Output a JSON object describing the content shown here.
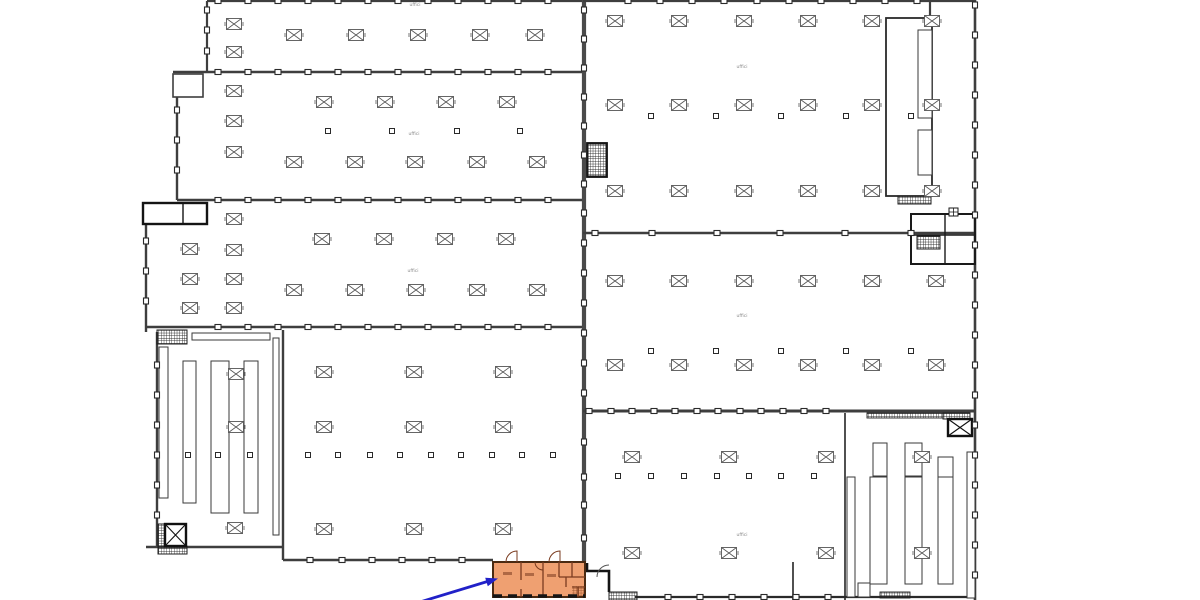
{
  "meta": {
    "description": "CAD floor plan of a large industrial building complex; column grid halls, racking areas, stair and lift cores, with a group of small rooms highlighted in orange at the bottom and a blue annotation arrow pointing to them",
    "canvas": {
      "width": 1200,
      "height": 600
    }
  },
  "colors": {
    "background": "#ffffff",
    "wall_gray": "#3e3e3e",
    "wall_black": "#141414",
    "divider_gray": "#4a4a4a",
    "column_stroke": "#555555",
    "dot_stroke": "#2a2a2a",
    "rack_stroke": "#3a3a3a",
    "hatch_stroke": "#1f1f1f",
    "highlight_fill": "#efa071",
    "highlight_wall": "#4a2a12",
    "highlight_inner": "#7a3b1f",
    "highlight_hatch": "#8a4520",
    "arrow_blue": "#2121c8",
    "label_gray": "#8a8a8a"
  },
  "labels": [
    {
      "text": "uffici",
      "x": 415,
      "y": 6
    },
    {
      "text": "uffici",
      "x": 414,
      "y": 135
    },
    {
      "text": "uffici",
      "x": 413,
      "y": 272
    },
    {
      "text": "uffici",
      "x": 742,
      "y": 68
    },
    {
      "text": "uffici",
      "x": 742,
      "y": 317
    },
    {
      "text": "uffici",
      "x": 742,
      "y": 536
    }
  ],
  "highlight": {
    "x": 493,
    "y": 562,
    "w": 92,
    "h": 35,
    "smudges": [
      [
        503,
        572,
        9,
        3
      ],
      [
        525,
        573,
        9,
        3
      ],
      [
        547,
        574,
        9,
        3
      ]
    ],
    "stair_hatch": [
      572,
      586,
      12,
      10
    ]
  },
  "arrow": {
    "x1": 420,
    "y1": 602,
    "x2": 489,
    "y2": 581,
    "tip": [
      498,
      578.5
    ],
    "head": [
      [
        498,
        578.5
      ],
      [
        487.8,
        586.3
      ],
      [
        485.2,
        577.7
      ]
    ]
  },
  "plan": {
    "xboxes": [
      [
        234,
        24
      ],
      [
        234,
        52
      ],
      [
        294,
        35
      ],
      [
        356,
        35
      ],
      [
        418,
        35
      ],
      [
        480,
        35
      ],
      [
        535,
        35
      ],
      [
        234,
        91
      ],
      [
        234,
        121
      ],
      [
        234,
        152
      ],
      [
        324,
        102
      ],
      [
        385,
        102
      ],
      [
        446,
        102
      ],
      [
        507,
        102
      ],
      [
        294,
        162
      ],
      [
        355,
        162
      ],
      [
        415,
        162
      ],
      [
        477,
        162
      ],
      [
        537,
        162
      ],
      [
        190,
        249
      ],
      [
        190,
        279
      ],
      [
        190,
        308
      ],
      [
        234,
        219
      ],
      [
        234,
        250
      ],
      [
        234,
        279
      ],
      [
        234,
        308
      ],
      [
        322,
        239
      ],
      [
        384,
        239
      ],
      [
        445,
        239
      ],
      [
        506,
        239
      ],
      [
        294,
        290
      ],
      [
        355,
        290
      ],
      [
        416,
        290
      ],
      [
        477,
        290
      ],
      [
        537,
        290
      ],
      [
        324,
        372
      ],
      [
        414,
        372
      ],
      [
        503,
        372
      ],
      [
        324,
        427
      ],
      [
        414,
        427
      ],
      [
        503,
        427
      ],
      [
        324,
        529
      ],
      [
        414,
        529
      ],
      [
        503,
        529
      ],
      [
        236,
        374
      ],
      [
        236,
        427
      ],
      [
        235,
        528
      ],
      [
        615,
        21
      ],
      [
        679,
        21
      ],
      [
        744,
        21
      ],
      [
        808,
        21
      ],
      [
        872,
        21
      ],
      [
        932,
        21
      ],
      [
        615,
        105
      ],
      [
        679,
        105
      ],
      [
        744,
        105
      ],
      [
        808,
        105
      ],
      [
        872,
        105
      ],
      [
        932,
        105
      ],
      [
        615,
        191
      ],
      [
        679,
        191
      ],
      [
        744,
        191
      ],
      [
        808,
        191
      ],
      [
        872,
        191
      ],
      [
        932,
        191
      ],
      [
        615,
        281
      ],
      [
        679,
        281
      ],
      [
        744,
        281
      ],
      [
        808,
        281
      ],
      [
        872,
        281
      ],
      [
        936,
        281
      ],
      [
        615,
        365
      ],
      [
        679,
        365
      ],
      [
        744,
        365
      ],
      [
        808,
        365
      ],
      [
        872,
        365
      ],
      [
        936,
        365
      ],
      [
        632,
        457
      ],
      [
        729,
        457
      ],
      [
        826,
        457
      ],
      [
        922,
        457
      ],
      [
        632,
        553
      ],
      [
        729,
        553
      ],
      [
        826,
        553
      ],
      [
        922,
        553
      ]
    ],
    "dots": [
      [
        328,
        131
      ],
      [
        392,
        131
      ],
      [
        457,
        131
      ],
      [
        520,
        131
      ],
      [
        308,
        455
      ],
      [
        338,
        455
      ],
      [
        370,
        455
      ],
      [
        400,
        455
      ],
      [
        431,
        455
      ],
      [
        461,
        455
      ],
      [
        492,
        455
      ],
      [
        522,
        455
      ],
      [
        553,
        455
      ],
      [
        188,
        455
      ],
      [
        218,
        455
      ],
      [
        250,
        455
      ],
      [
        651,
        116
      ],
      [
        716,
        116
      ],
      [
        781,
        116
      ],
      [
        846,
        116
      ],
      [
        911,
        116
      ],
      [
        651,
        351
      ],
      [
        716,
        351
      ],
      [
        781,
        351
      ],
      [
        846,
        351
      ],
      [
        911,
        351
      ],
      [
        618,
        476
      ],
      [
        651,
        476
      ],
      [
        684,
        476
      ],
      [
        717,
        476
      ],
      [
        749,
        476
      ],
      [
        781,
        476
      ],
      [
        814,
        476
      ]
    ],
    "wall_dots_h": [
      [
        1,
        [
          218,
          248,
          278,
          308,
          338,
          368,
          398,
          428,
          458,
          488,
          518,
          548
        ]
      ],
      [
        1,
        [
          628,
          660,
          692,
          724,
          757,
          789,
          821,
          853,
          885,
          917
        ]
      ],
      [
        72,
        [
          218,
          248,
          278,
          308,
          338,
          368,
          398,
          428,
          458,
          488,
          518,
          548
        ]
      ],
      [
        200,
        [
          218,
          248,
          278,
          308,
          338,
          368,
          398,
          428,
          458,
          488,
          518,
          548
        ]
      ],
      [
        327,
        [
          218,
          248,
          278,
          308,
          338,
          368,
          398,
          428,
          458,
          488,
          518,
          548
        ]
      ],
      [
        233,
        [
          595,
          652,
          717,
          780,
          845,
          911
        ]
      ],
      [
        411,
        [
          589,
          611,
          632,
          654,
          675,
          697,
          718,
          740,
          761,
          783,
          804,
          826
        ]
      ],
      [
        560,
        [
          310,
          342,
          372,
          402,
          432,
          462
        ]
      ],
      [
        597,
        [
          668,
          700,
          732,
          764,
          796,
          828
        ]
      ]
    ],
    "wall_dots_v": [
      [
        207,
        [
          10,
          30,
          51
        ]
      ],
      [
        177,
        [
          110,
          140,
          170
        ]
      ],
      [
        146,
        [
          241,
          271,
          301
        ]
      ],
      [
        157,
        [
          365,
          395,
          425,
          455,
          485,
          515
        ]
      ],
      [
        584,
        [
          10,
          39,
          68,
          97,
          126,
          155,
          184,
          213,
          243,
          273,
          303,
          333,
          363,
          393,
          442,
          477,
          505,
          538
        ]
      ],
      [
        975,
        [
          5,
          35,
          65,
          95,
          125,
          155,
          185,
          215,
          245,
          275,
          305,
          335,
          365,
          395,
          425,
          455,
          485,
          515,
          545,
          575
        ]
      ]
    ],
    "racks": [
      [
        192,
        333,
        78,
        7
      ],
      [
        159,
        347,
        9,
        151
      ],
      [
        183,
        361,
        13,
        142
      ],
      [
        211,
        361,
        18,
        152
      ],
      [
        244,
        361,
        14,
        152
      ],
      [
        273,
        338,
        6,
        197
      ],
      [
        847,
        477,
        8,
        120
      ],
      [
        873,
        443,
        14,
        33
      ],
      [
        870,
        477,
        17,
        107
      ],
      [
        905,
        443,
        17,
        33
      ],
      [
        905,
        477,
        17,
        107
      ],
      [
        938,
        457,
        15,
        20
      ],
      [
        938,
        477,
        15,
        107
      ],
      [
        967,
        452,
        8,
        146
      ],
      [
        918,
        30,
        14,
        88
      ],
      [
        918,
        130,
        14,
        45
      ],
      [
        858,
        583,
        12,
        14
      ]
    ],
    "hatch_racks": [
      [
        867,
        413,
        76,
        5
      ],
      [
        880,
        592,
        30,
        6
      ]
    ],
    "hatches": [
      [
        157,
        330,
        30,
        14
      ],
      [
        158,
        524,
        8,
        22
      ],
      [
        158,
        546,
        29,
        8
      ],
      [
        588,
        144,
        18,
        32
      ],
      [
        898,
        196,
        33,
        8
      ],
      [
        917,
        236,
        23,
        13
      ],
      [
        609,
        592,
        28,
        8
      ],
      [
        943,
        413,
        27,
        6
      ]
    ],
    "lift_boxes": [
      [
        165,
        524,
        21,
        22
      ],
      [
        948,
        419,
        24,
        17
      ]
    ],
    "grid_icon": [
      949,
      208,
      9,
      8
    ]
  }
}
